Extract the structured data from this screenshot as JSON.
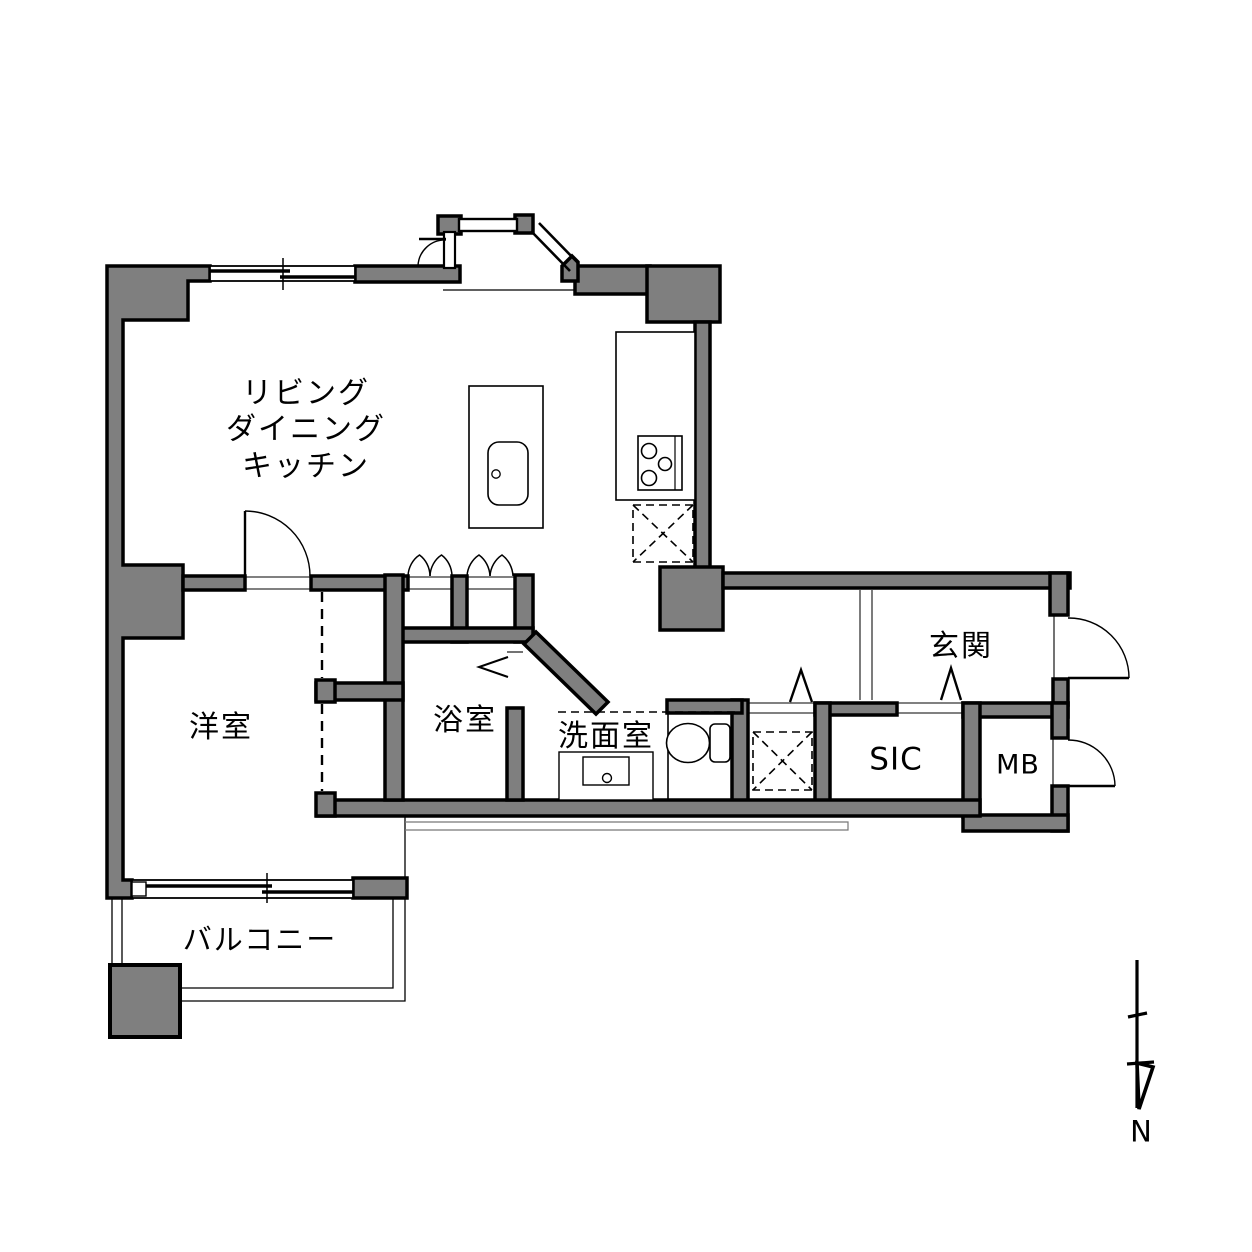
{
  "document": {
    "type": "apartment-floor-plan"
  },
  "colors": {
    "wall_fill": "#7f7f7f",
    "wall_outline": "#000000",
    "background": "#ffffff",
    "thin_line": "#666666"
  },
  "rooms": {
    "ldk": {
      "line1": "リビング",
      "line2": "ダイニング",
      "line3": "キッチン"
    },
    "western_room": {
      "label": "洋室"
    },
    "bathroom": {
      "label": "浴室"
    },
    "washroom": {
      "label": "洗面室"
    },
    "entrance": {
      "label": "玄関"
    },
    "shoe_in_closet": {
      "label": "SIC"
    },
    "meter_box": {
      "label": "MB"
    },
    "balcony": {
      "label": "バルコニー"
    }
  },
  "compass": {
    "north_label": "N"
  }
}
